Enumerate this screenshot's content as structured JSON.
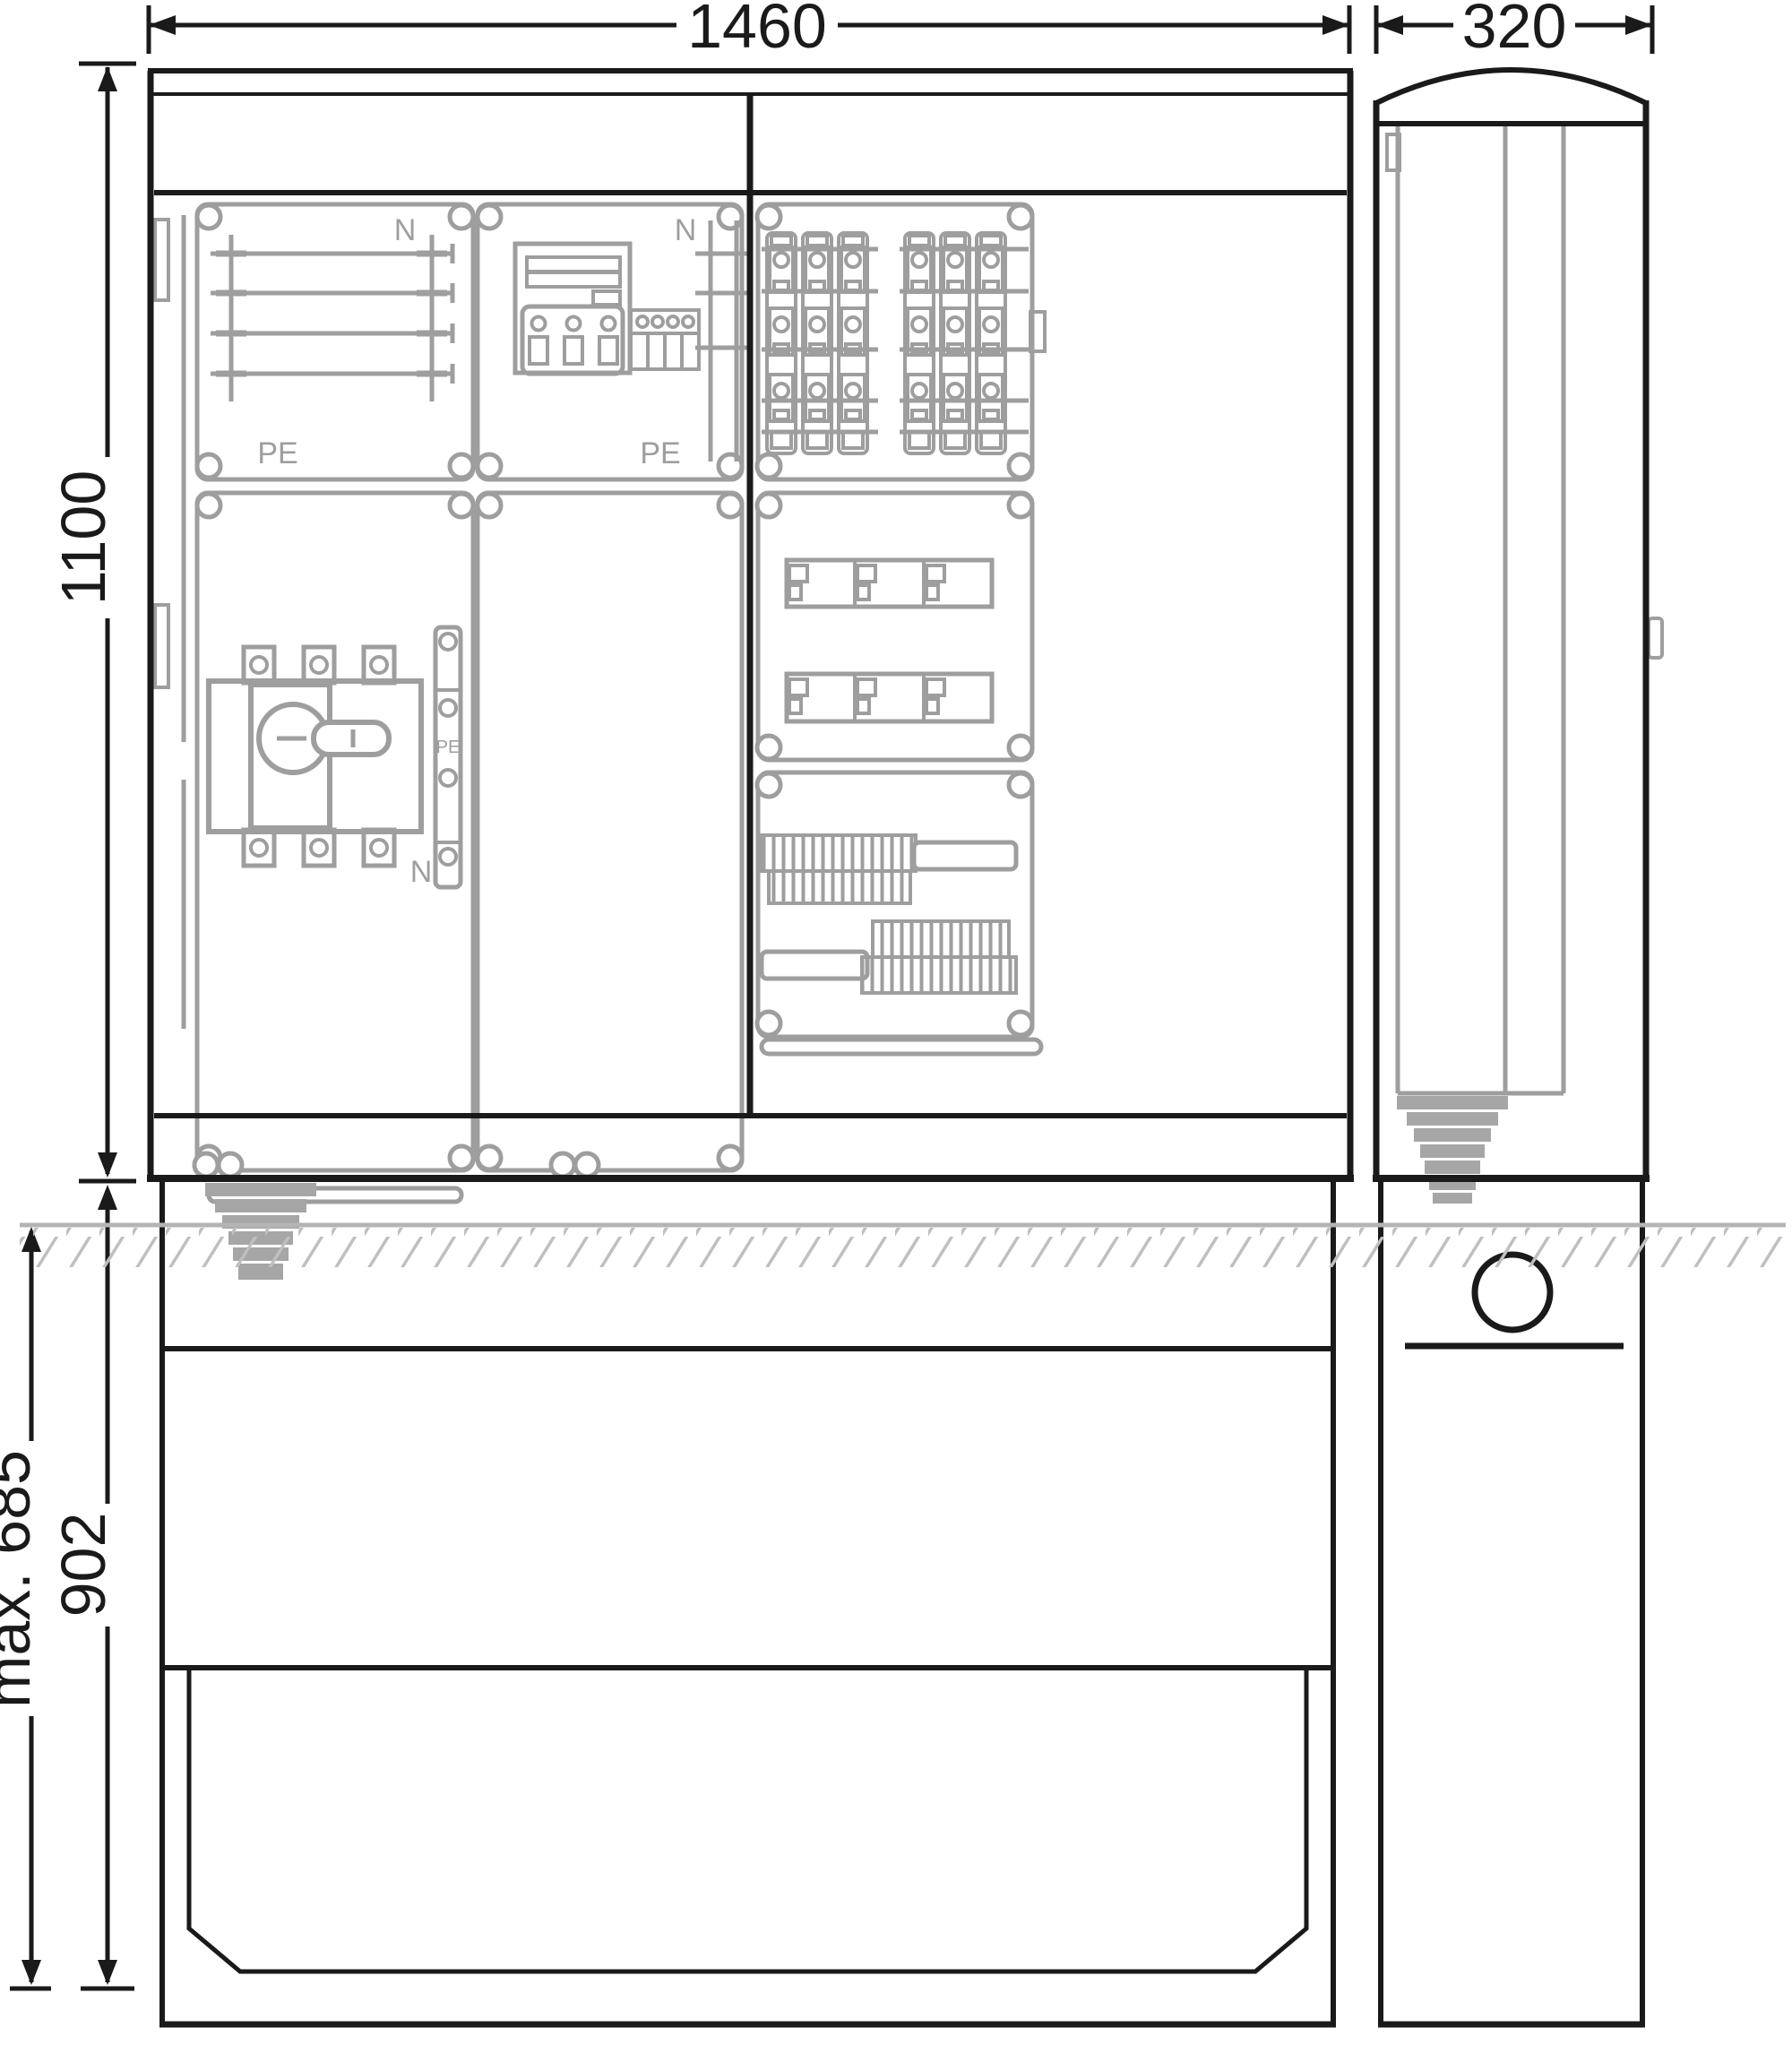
{
  "drawing": {
    "dimensions": {
      "front_width": "1460",
      "side_width": "320",
      "body_height": "1100",
      "pedestal_height": "902",
      "foundation_depth": "max. 685"
    },
    "labels": {
      "busbar_panel_n": "N",
      "busbar_panel_pe": "PE",
      "meter_panel_n": "N",
      "meter_panel_pe": "PE",
      "switch_rail_pe": "PE",
      "switch_rail_n": "N"
    },
    "colors": {
      "line": "#1a1a1a",
      "component": "#9e9e9e",
      "ground": "#b4b4b4",
      "hatch": "#bfbfbf"
    }
  }
}
